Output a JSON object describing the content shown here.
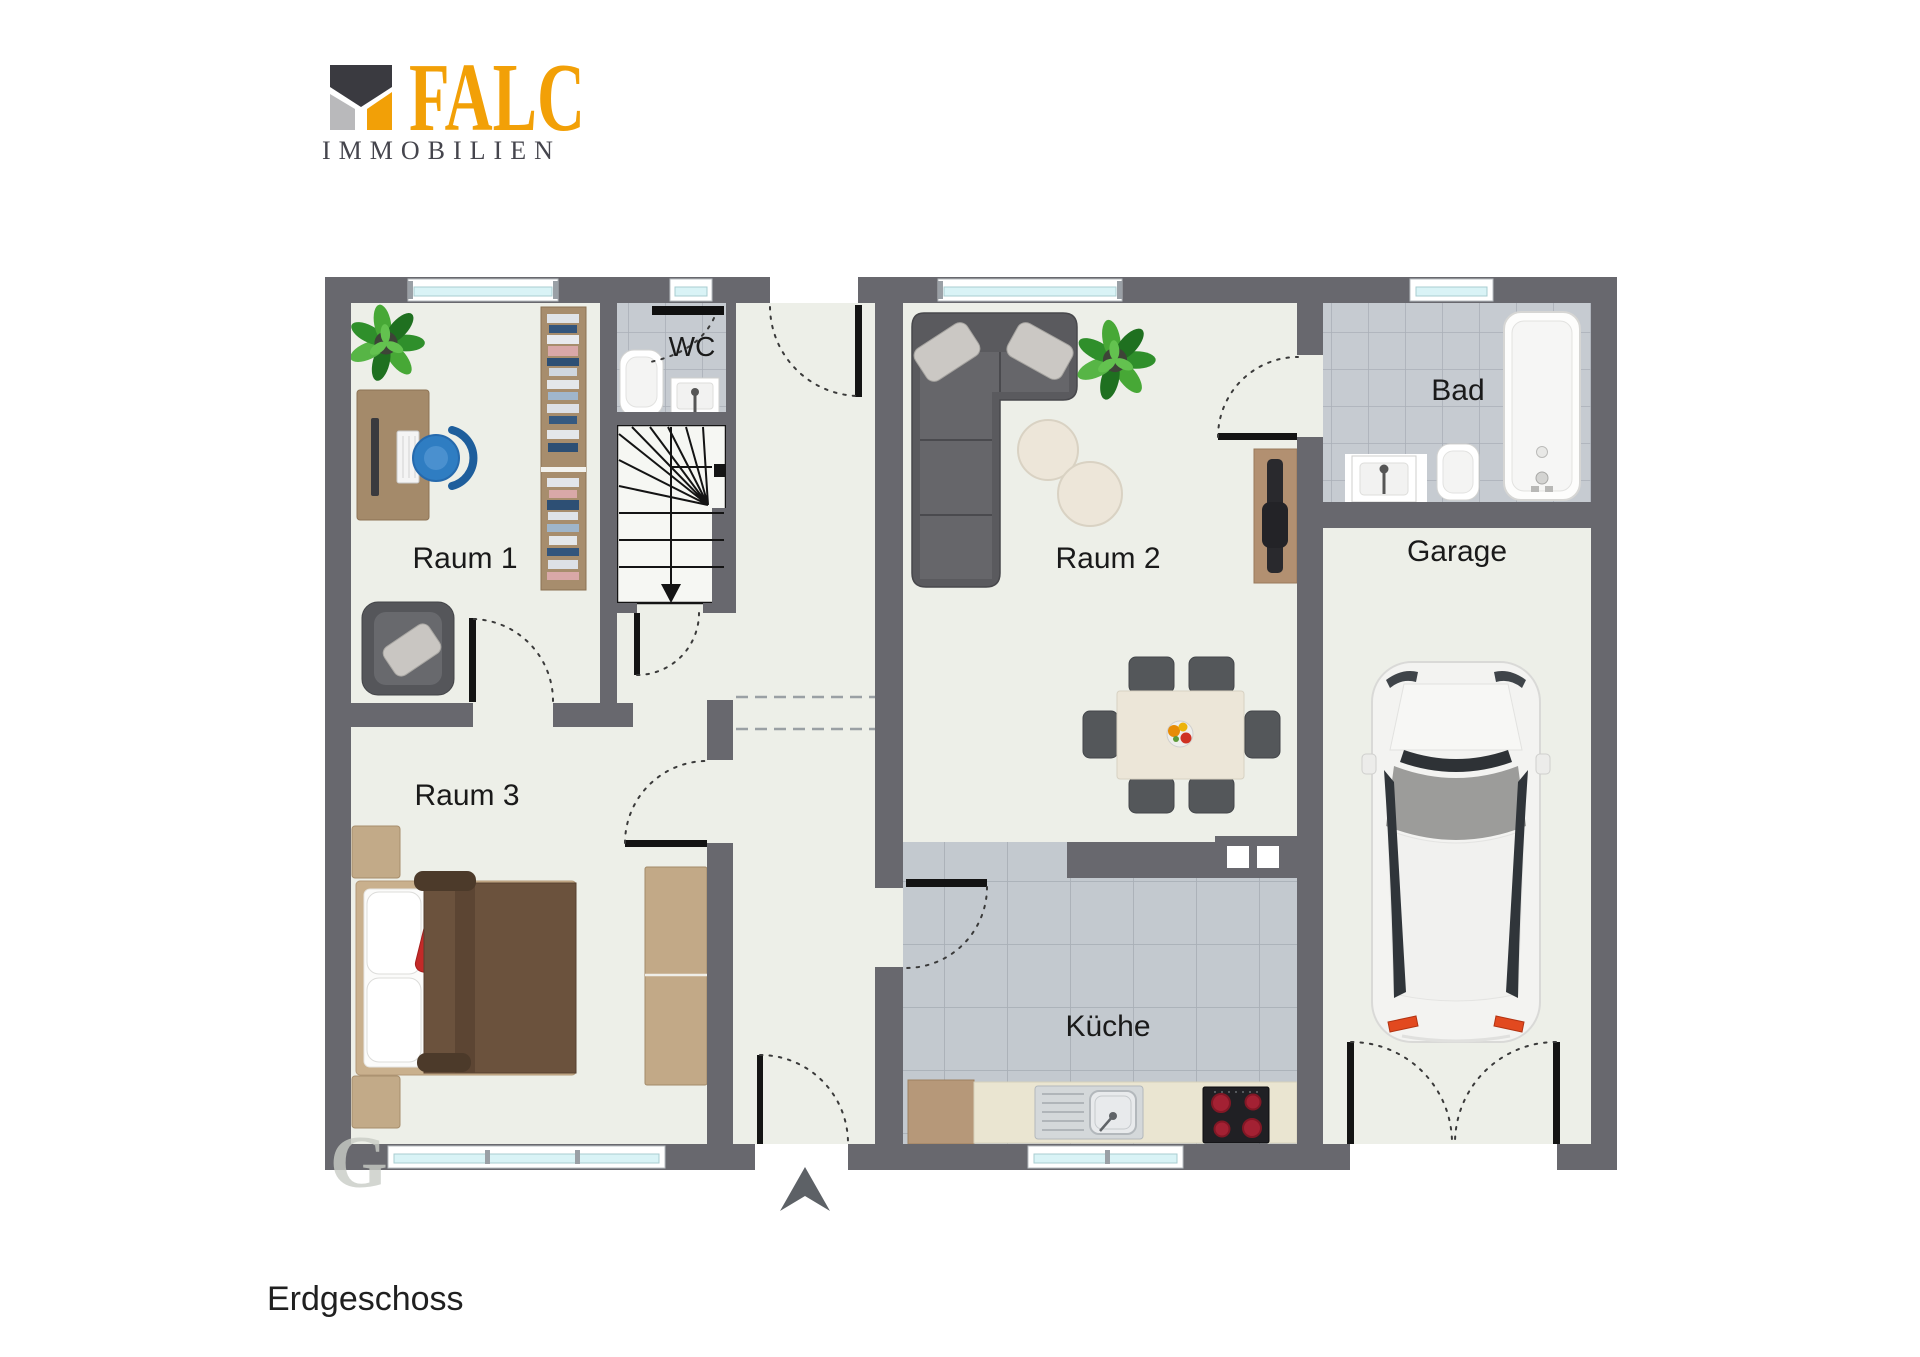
{
  "logo": {
    "brand": "FALC",
    "subtitle": "IMMOBILIEN"
  },
  "plan": {
    "floor_label": "Erdgeschoss",
    "rooms": {
      "room1": "Raum 1",
      "wc": "WC",
      "room2": "Raum 2",
      "bad": "Bad",
      "garage": "Garage",
      "room3": "Raum 3",
      "kueche": "Küche"
    }
  },
  "watermark": "G",
  "colors": {
    "wall": "#68686e",
    "floor": "#edefe8",
    "tile": "#c6cbd1",
    "tile_line": "#aab0b8",
    "ktile": "#c3c9cf",
    "glass": "#d9f3f6",
    "brand_orange": "#f2a007",
    "brand_gray": "#45454d",
    "accent_red": "#c32a28",
    "label": "#1a1a1a",
    "wood": "#a98f6f"
  }
}
